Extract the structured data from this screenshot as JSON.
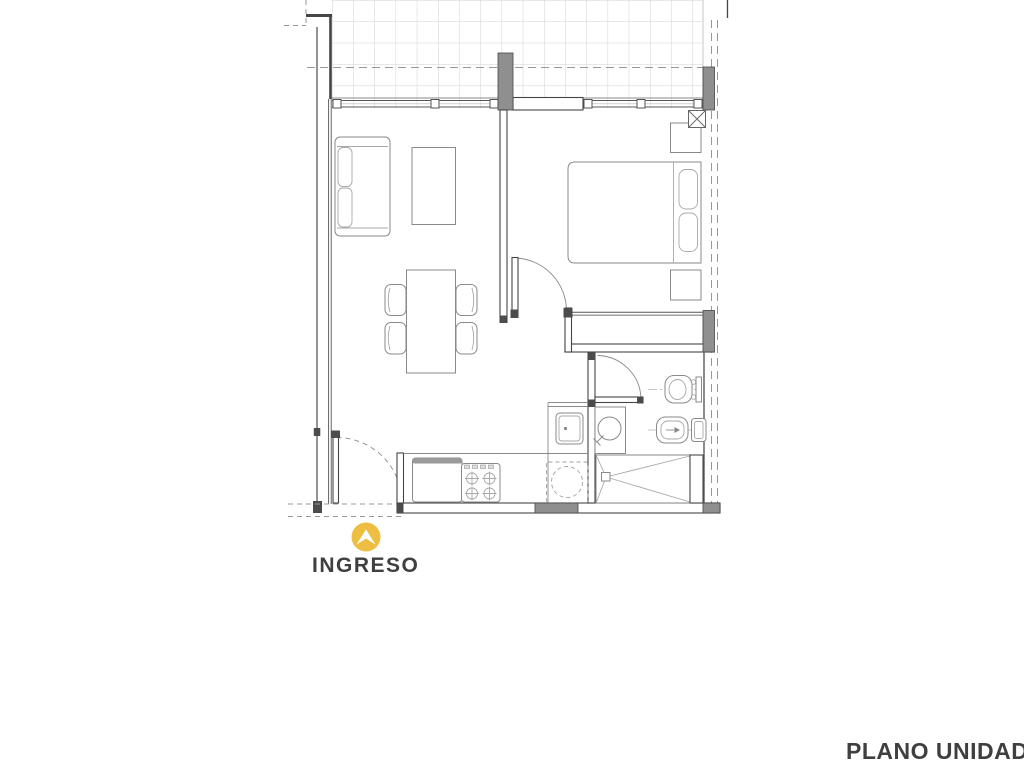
{
  "labels": {
    "entrance": "INGRESO",
    "plan_title": "PLANO UNIDAD"
  },
  "icons": {
    "entrance_marker": "chevron-up-in-yellow-circle"
  },
  "colors": {
    "wall": "#454545",
    "wall_dark": "#4c4c4c",
    "pillar": "#8f8f8f",
    "furn": "#8a8a8a",
    "furn_light": "#a8a8a8",
    "fix": "#8a8a8a",
    "grid": "#d2d2d2",
    "dash": "#979797",
    "text": "#3f3f3f",
    "accent": "#edbe41"
  }
}
